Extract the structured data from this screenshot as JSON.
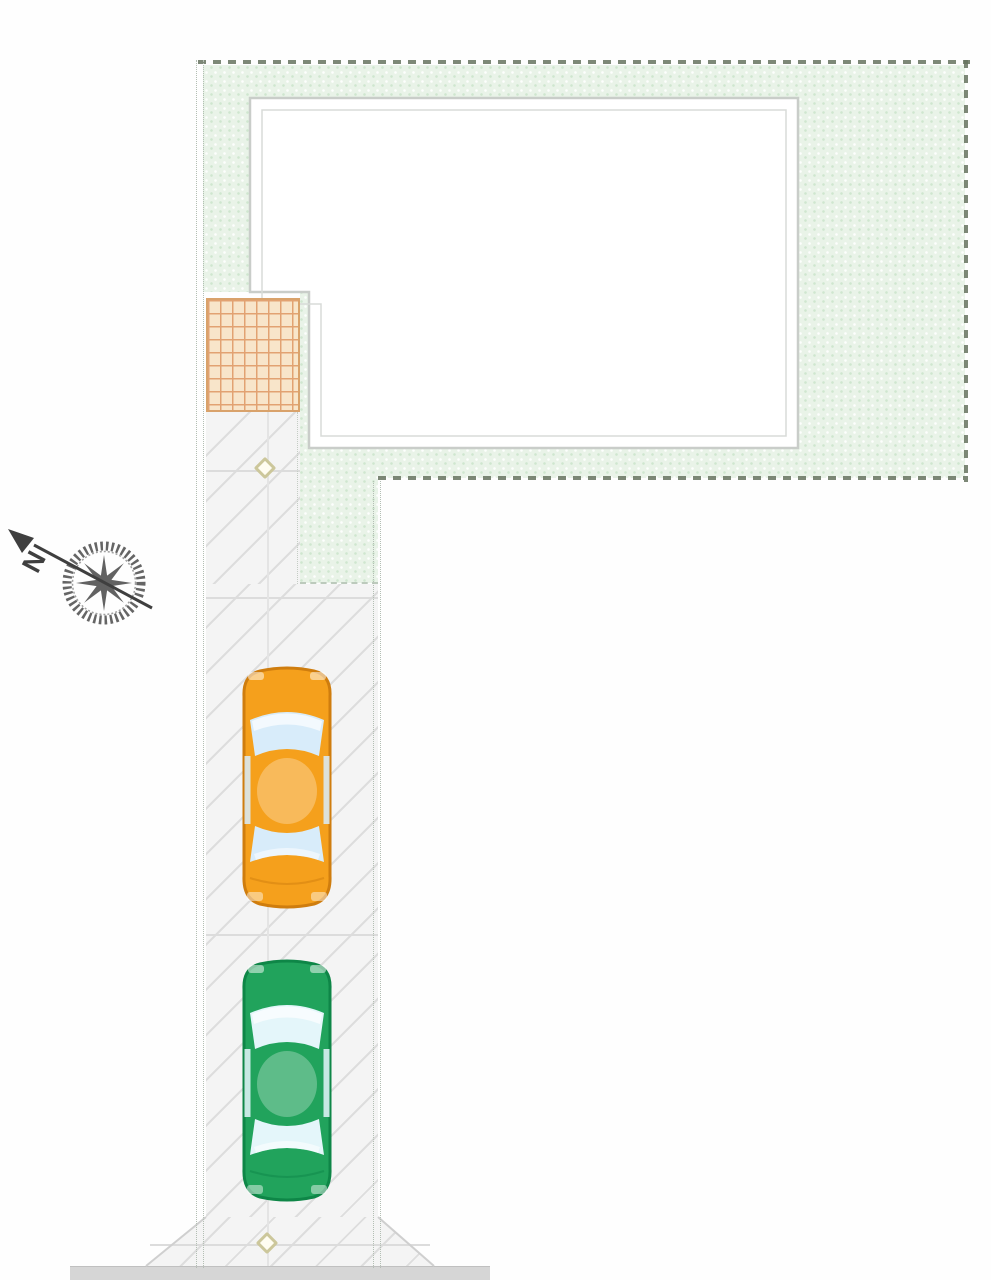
{
  "compass": {
    "label": "N"
  },
  "colors": {
    "garden_fill": "#e9f3e8",
    "garden_speckle": "#cfe6cf",
    "boundary_dark": "#66735f",
    "boundary_light": "#b3beb3",
    "building_stroke": "#c9cdc9",
    "building_inner_stroke": "#d8dbd8",
    "tile_fill": "#f8e5ca",
    "tile_grid": "#e2a272",
    "tile_border": "#d9a26b",
    "pavement_fill": "#f4f4f4",
    "pavement_hatch": "#dddddd",
    "stall_line": "#dcdcdc",
    "road_fill": "#d6d6d6",
    "diamond_border": "#ccc79b",
    "car_orange_body": "#f5a01c",
    "car_orange_outline": "#cf7d0e",
    "car_orange_window": "#d8ecfa",
    "car_green_body": "#21a35c",
    "car_green_outline": "#0e8647",
    "car_green_window": "#e4f6fa",
    "compass_ink": "#3f3f3f"
  }
}
